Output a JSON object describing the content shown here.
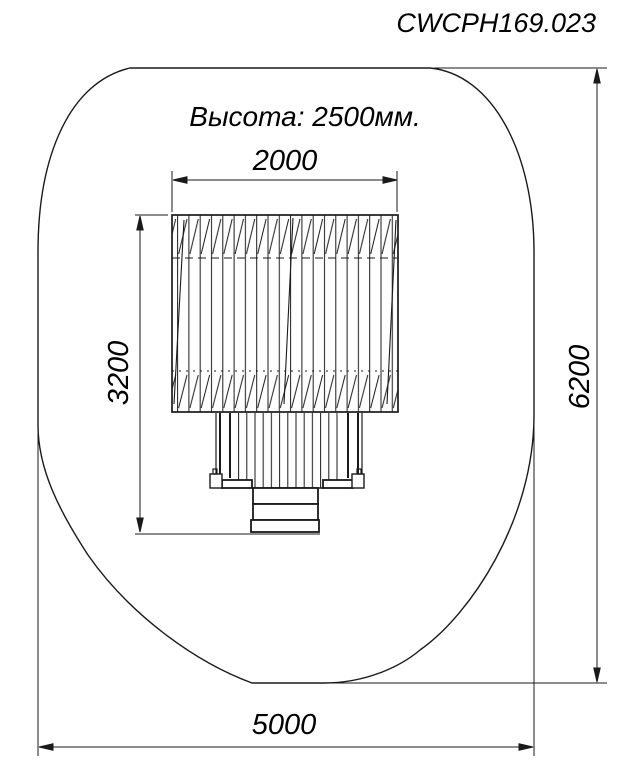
{
  "drawing": {
    "title": "CWCPH169.023",
    "height_note": "Высота: 2500мм.",
    "dimensions": {
      "top_width": "2000",
      "left_height": "3200",
      "right_height": "6200",
      "bottom_width": "5000"
    },
    "line_color": "#1a1a1a",
    "text_color": "#000000",
    "background": "#ffffff"
  }
}
